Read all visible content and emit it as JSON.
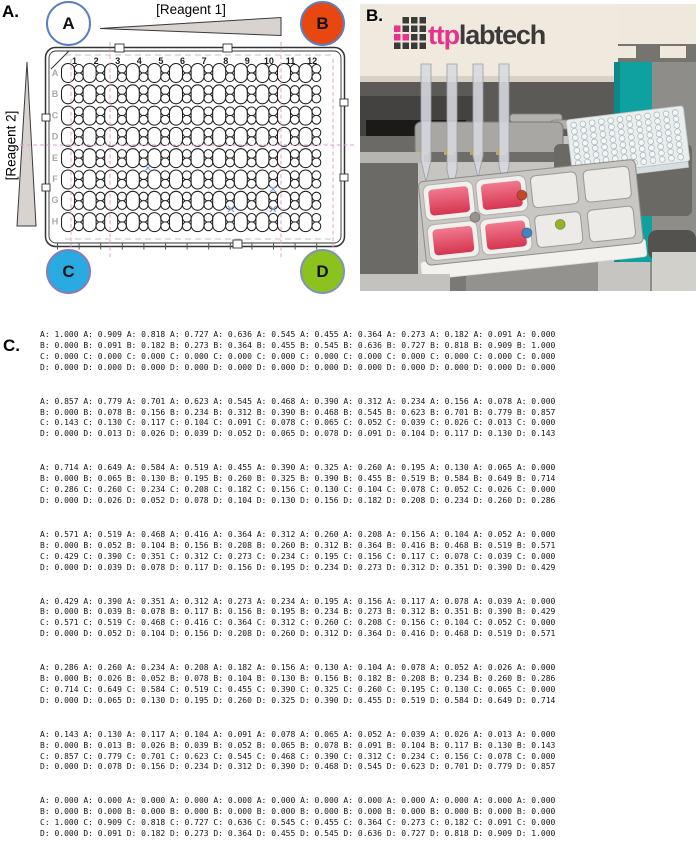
{
  "panel_a": {
    "label": "A.",
    "reagent1_label": "[Reagent 1]",
    "reagent2_label": "[Reagent 2]",
    "wedge_fill": "#d9d3cf",
    "pink_guide": "#dd9cc8",
    "corners": [
      {
        "letter": "A",
        "fill": "#ffffff",
        "border": "#5b7fc5"
      },
      {
        "letter": "B",
        "fill": "#e8470f",
        "border": "#5b7fc5"
      },
      {
        "letter": "C",
        "fill": "#29abe2",
        "border": "#8a7ab8"
      },
      {
        "letter": "D",
        "fill": "#8cc21e",
        "border": "#7f94b8"
      }
    ],
    "plate": {
      "column_labels": [
        "1",
        "2",
        "3",
        "4",
        "5",
        "6",
        "7",
        "8",
        "9",
        "10",
        "11",
        "12"
      ],
      "row_labels": [
        "A",
        "B",
        "C",
        "D",
        "E",
        "F",
        "G",
        "H"
      ],
      "rows": 8,
      "cols": 12
    }
  },
  "panel_b": {
    "label": "B.",
    "logo": {
      "prefix": "ttp",
      "suffix": "labtech",
      "magenta": "#e8338d",
      "dark": "#3b3a39",
      "grid": [
        [
          "none",
          "dark",
          "dark",
          "dark"
        ],
        [
          "magenta",
          "dark",
          "dark",
          "dark"
        ],
        [
          "magenta",
          "magenta",
          "dark",
          "dark"
        ],
        [
          "dark",
          "dark",
          "dark",
          "dark"
        ]
      ]
    },
    "teal_accent": "#0fa0a0",
    "liquid_color_top": "#f07a8e",
    "liquid_color_bottom": "#d63550",
    "dot_colors": {
      "red": "#c4472a",
      "blue": "#3f86c4",
      "green": "#93b32a",
      "gray": "#97948d"
    },
    "microplate": {
      "rows": 8,
      "cols": 12
    }
  },
  "panel_c": {
    "label": "C.",
    "row_labels": [
      "A",
      "B",
      "C",
      "D"
    ],
    "blocks": [
      {
        "rows": [
          {
            "label": "A",
            "values": [
              1.0,
              0.909,
              0.818,
              0.727,
              0.636,
              0.545,
              0.455,
              0.364,
              0.273,
              0.182,
              0.091,
              0.0
            ]
          },
          {
            "label": "B",
            "values": [
              0.0,
              0.091,
              0.182,
              0.273,
              0.364,
              0.455,
              0.545,
              0.636,
              0.727,
              0.818,
              0.909,
              1.0
            ]
          },
          {
            "label": "C",
            "values": [
              0.0,
              0.0,
              0.0,
              0.0,
              0.0,
              0.0,
              0.0,
              0.0,
              0.0,
              0.0,
              0.0,
              0.0
            ]
          },
          {
            "label": "D",
            "values": [
              0.0,
              0.0,
              0.0,
              0.0,
              0.0,
              0.0,
              0.0,
              0.0,
              0.0,
              0.0,
              0.0,
              0.0
            ]
          }
        ]
      },
      {
        "rows": [
          {
            "label": "A",
            "values": [
              0.857,
              0.779,
              0.701,
              0.623,
              0.545,
              0.468,
              0.39,
              0.312,
              0.234,
              0.156,
              0.078,
              0.0
            ]
          },
          {
            "label": "B",
            "values": [
              0.0,
              0.078,
              0.156,
              0.234,
              0.312,
              0.39,
              0.468,
              0.545,
              0.623,
              0.701,
              0.779,
              0.857
            ]
          },
          {
            "label": "C",
            "values": [
              0.143,
              0.13,
              0.117,
              0.104,
              0.091,
              0.078,
              0.065,
              0.052,
              0.039,
              0.026,
              0.013,
              0.0
            ]
          },
          {
            "label": "D",
            "values": [
              0.0,
              0.013,
              0.026,
              0.039,
              0.052,
              0.065,
              0.078,
              0.091,
              0.104,
              0.117,
              0.13,
              0.143
            ]
          }
        ]
      },
      {
        "rows": [
          {
            "label": "A",
            "values": [
              0.714,
              0.649,
              0.584,
              0.519,
              0.455,
              0.39,
              0.325,
              0.26,
              0.195,
              0.13,
              0.065,
              0.0
            ]
          },
          {
            "label": "B",
            "values": [
              0.0,
              0.065,
              0.13,
              0.195,
              0.26,
              0.325,
              0.39,
              0.455,
              0.519,
              0.584,
              0.649,
              0.714
            ]
          },
          {
            "label": "C",
            "values": [
              0.286,
              0.26,
              0.234,
              0.208,
              0.182,
              0.156,
              0.13,
              0.104,
              0.078,
              0.052,
              0.026,
              0.0
            ]
          },
          {
            "label": "D",
            "values": [
              0.0,
              0.026,
              0.052,
              0.078,
              0.104,
              0.13,
              0.156,
              0.182,
              0.208,
              0.234,
              0.26,
              0.286
            ]
          }
        ]
      },
      {
        "rows": [
          {
            "label": "A",
            "values": [
              0.571,
              0.519,
              0.468,
              0.416,
              0.364,
              0.312,
              0.26,
              0.208,
              0.156,
              0.104,
              0.052,
              0.0
            ]
          },
          {
            "label": "B",
            "values": [
              0.0,
              0.052,
              0.104,
              0.156,
              0.208,
              0.26,
              0.312,
              0.364,
              0.416,
              0.468,
              0.519,
              0.571
            ]
          },
          {
            "label": "C",
            "values": [
              0.429,
              0.39,
              0.351,
              0.312,
              0.273,
              0.234,
              0.195,
              0.156,
              0.117,
              0.078,
              0.039,
              0.0
            ]
          },
          {
            "label": "D",
            "values": [
              0.0,
              0.039,
              0.078,
              0.117,
              0.156,
              0.195,
              0.234,
              0.273,
              0.312,
              0.351,
              0.39,
              0.429
            ]
          }
        ]
      },
      {
        "rows": [
          {
            "label": "A",
            "values": [
              0.429,
              0.39,
              0.351,
              0.312,
              0.273,
              0.234,
              0.195,
              0.156,
              0.117,
              0.078,
              0.039,
              0.0
            ]
          },
          {
            "label": "B",
            "values": [
              0.0,
              0.039,
              0.078,
              0.117,
              0.156,
              0.195,
              0.234,
              0.273,
              0.312,
              0.351,
              0.39,
              0.429
            ]
          },
          {
            "label": "C",
            "values": [
              0.571,
              0.519,
              0.468,
              0.416,
              0.364,
              0.312,
              0.26,
              0.208,
              0.156,
              0.104,
              0.052,
              0.0
            ]
          },
          {
            "label": "D",
            "values": [
              0.0,
              0.052,
              0.104,
              0.156,
              0.208,
              0.26,
              0.312,
              0.364,
              0.416,
              0.468,
              0.519,
              0.571
            ]
          }
        ]
      },
      {
        "rows": [
          {
            "label": "A",
            "values": [
              0.286,
              0.26,
              0.234,
              0.208,
              0.182,
              0.156,
              0.13,
              0.104,
              0.078,
              0.052,
              0.026,
              0.0
            ]
          },
          {
            "label": "B",
            "values": [
              0.0,
              0.026,
              0.052,
              0.078,
              0.104,
              0.13,
              0.156,
              0.182,
              0.208,
              0.234,
              0.26,
              0.286
            ]
          },
          {
            "label": "C",
            "values": [
              0.714,
              0.649,
              0.584,
              0.519,
              0.455,
              0.39,
              0.325,
              0.26,
              0.195,
              0.13,
              0.065,
              0.0
            ]
          },
          {
            "label": "D",
            "values": [
              0.0,
              0.065,
              0.13,
              0.195,
              0.26,
              0.325,
              0.39,
              0.455,
              0.519,
              0.584,
              0.649,
              0.714
            ]
          }
        ]
      },
      {
        "rows": [
          {
            "label": "A",
            "values": [
              0.143,
              0.13,
              0.117,
              0.104,
              0.091,
              0.078,
              0.065,
              0.052,
              0.039,
              0.026,
              0.013,
              0.0
            ]
          },
          {
            "label": "B",
            "values": [
              0.0,
              0.013,
              0.026,
              0.039,
              0.052,
              0.065,
              0.078,
              0.091,
              0.104,
              0.117,
              0.13,
              0.143
            ]
          },
          {
            "label": "C",
            "values": [
              0.857,
              0.779,
              0.701,
              0.623,
              0.545,
              0.468,
              0.39,
              0.312,
              0.234,
              0.156,
              0.078,
              0.0
            ]
          },
          {
            "label": "D",
            "values": [
              0.0,
              0.078,
              0.156,
              0.234,
              0.312,
              0.39,
              0.468,
              0.545,
              0.623,
              0.701,
              0.779,
              0.857
            ]
          }
        ]
      },
      {
        "rows": [
          {
            "label": "A",
            "values": [
              0.0,
              0.0,
              0.0,
              0.0,
              0.0,
              0.0,
              0.0,
              0.0,
              0.0,
              0.0,
              0.0,
              0.0
            ]
          },
          {
            "label": "B",
            "values": [
              0.0,
              0.0,
              0.0,
              0.0,
              0.0,
              0.0,
              0.0,
              0.0,
              0.0,
              0.0,
              0.0,
              0.0
            ]
          },
          {
            "label": "C",
            "values": [
              1.0,
              0.909,
              0.818,
              0.727,
              0.636,
              0.545,
              0.455,
              0.364,
              0.273,
              0.182,
              0.091,
              0.0
            ]
          },
          {
            "label": "D",
            "values": [
              0.0,
              0.091,
              0.182,
              0.273,
              0.364,
              0.455,
              0.545,
              0.636,
              0.727,
              0.818,
              0.909,
              1.0
            ]
          }
        ]
      }
    ]
  }
}
